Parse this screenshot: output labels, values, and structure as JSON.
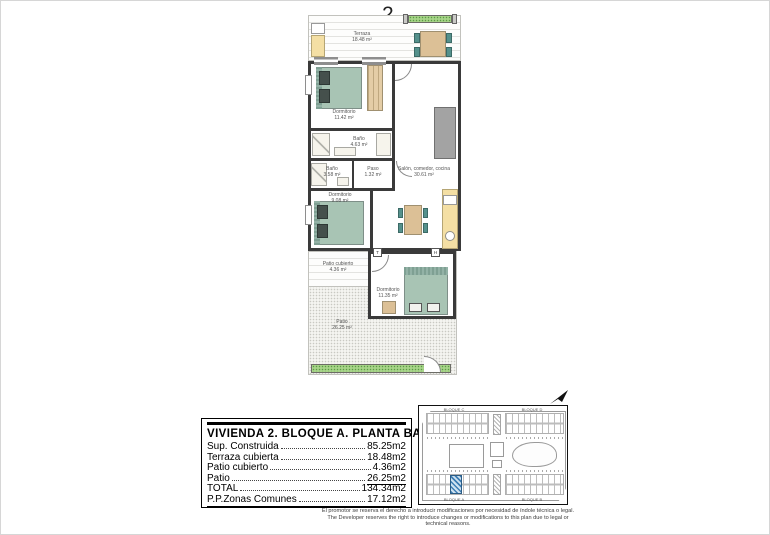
{
  "unit_number": "2",
  "floor_plan": {
    "terraza": {
      "name": "Terraza",
      "area": "18.48 m²"
    },
    "dormitorio1": {
      "name": "Dormitorio",
      "area": "11.42 m²"
    },
    "bano1": {
      "name": "Baño",
      "area": "4.63 m²"
    },
    "bano2": {
      "name": "Baño",
      "area": "3.58 m²"
    },
    "paso": {
      "name": "Paso",
      "area": "1.32 m²"
    },
    "salon": {
      "name": "Salón, comedor, cocina",
      "area": "30.61 m²"
    },
    "dormitorio2": {
      "name": "Dormitorio",
      "area": "9.08 m²"
    },
    "dormitorio3": {
      "name": "Dormitorio",
      "area": "11.35 m²"
    },
    "patio_cubierto": {
      "name": "Patio cubierto",
      "area": "4.36 m²"
    },
    "patio": {
      "name": "Patio",
      "area": "26.25 m²"
    },
    "fixture_t": "T",
    "fixture_h": "H"
  },
  "summary_table": {
    "title": "VIVIENDA 2. BLOQUE A. PLANTA BAJA",
    "rows": [
      {
        "label": "Sup. Construida",
        "value": "85.25m2"
      },
      {
        "label": "Terraza cubierta",
        "value": "18.48m2"
      },
      {
        "label": "Patio cubierto",
        "value": "4.36m2"
      },
      {
        "label": "Patio",
        "value": "26.25m2"
      },
      {
        "label": "TOTAL",
        "value": "134.34m2"
      },
      {
        "label": "P.P.Zonas Comunes",
        "value": "17.12m2"
      }
    ]
  },
  "site_plan": {
    "block_top_left": "BLOQUE C",
    "block_top_right": "BLOQUE D",
    "block_bottom_left": "BLOQUE A",
    "block_bottom_right": "BLOQUE B",
    "highlight_color": "#4a8fc7"
  },
  "disclaimer": {
    "line1": "El promotor se reserva el derecho a introducir modificaciones por necesidad de índole técnica o legal.",
    "line2": "The Developer reserves the right to introduce changes or modifications to this plan due to legal or technical reasons."
  },
  "colors": {
    "wall": "#3a3a3a",
    "bed": "#a8c4b4",
    "wood": "#dcc096",
    "planter_green": "#a7d489",
    "highlight_blue": "#4a8fc7"
  }
}
